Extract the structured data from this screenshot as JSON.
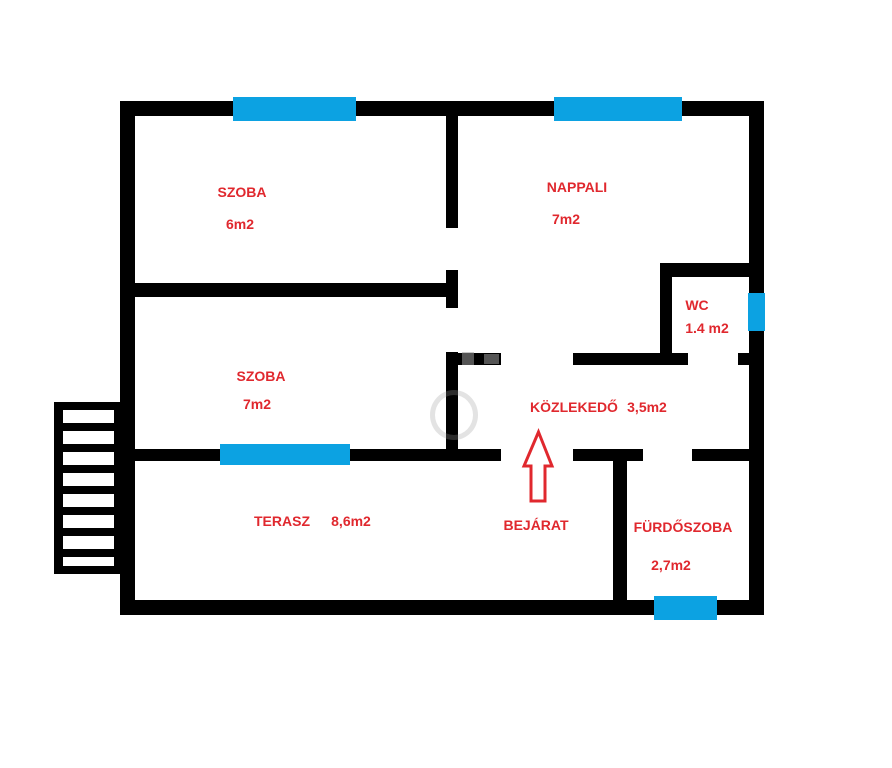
{
  "page": {
    "type": "floor-plan",
    "background": "#ffffff",
    "width": 892,
    "height": 768
  },
  "colors": {
    "wall": "#000000",
    "window": "#0ca2e2",
    "label": "#e0282e",
    "arrow_outline": "#e0282e",
    "watermark": "#9a9a9a"
  },
  "rooms": [
    {
      "id": "szoba-1",
      "name": "SZOBA",
      "area": "6m2"
    },
    {
      "id": "nappali",
      "name": "NAPPALI",
      "area": "7m2"
    },
    {
      "id": "wc",
      "name": "WC",
      "area": "1.4 m2"
    },
    {
      "id": "szoba-2",
      "name": "SZOBA",
      "area": "7m2"
    },
    {
      "id": "kozlekedo",
      "name": "KÖZLEKEDŐ",
      "area": "3,5m2"
    },
    {
      "id": "terasz",
      "name": "TERASZ",
      "area": "8,6m2"
    },
    {
      "id": "furdoszoba",
      "name": "FÜRDŐSZOBA",
      "area": "2,7m2"
    }
  ],
  "entrance": {
    "label": "BEJÁRAT"
  },
  "icons": {
    "entrance_arrow": "entrance-arrow-icon",
    "stairs": "stairs-icon",
    "windows_count": 5
  }
}
